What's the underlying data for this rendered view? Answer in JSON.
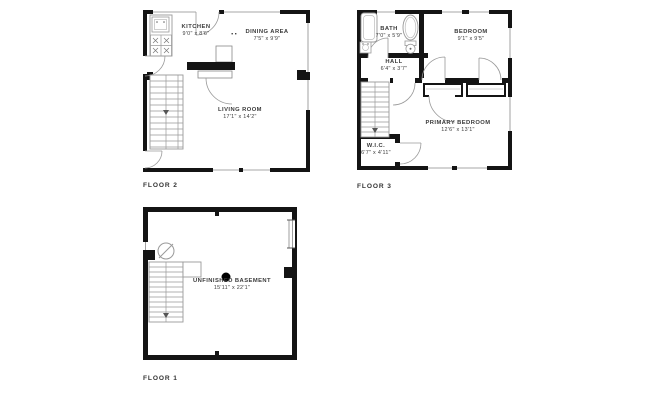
{
  "colors": {
    "wall": "#141414",
    "fixture_line": "#999999",
    "text": "#333333",
    "background": "#ffffff"
  },
  "floor2": {
    "label": "FLOOR 2",
    "kitchen": {
      "name": "KITCHEN",
      "dims": "9'0\" x 8'6\""
    },
    "dining": {
      "name": "DINING AREA",
      "dims": "7'5\" x 9'9\""
    },
    "living": {
      "name": "LIVING ROOM",
      "dims": "17'1\" x 14'2\""
    },
    "fixtures": [
      "stove-icon",
      "sink-icon",
      "stairs-icon",
      "door-arcs",
      "windows"
    ]
  },
  "floor3": {
    "label": "FLOOR 3",
    "bath": {
      "name": "BATH",
      "dims": "7'0\" x 5'9\""
    },
    "bedroom": {
      "name": "BEDROOM",
      "dims": "9'1\" x 9'5\""
    },
    "hall": {
      "name": "HALL",
      "dims": "6'4\" x 3'7\""
    },
    "primary": {
      "name": "PRIMARY BEDROOM",
      "dims": "12'6\" x 13'1\""
    },
    "wic": {
      "name": "W.I.C.",
      "dims": "6'7\" x 4'11\""
    },
    "fixtures": [
      "bathtub-icon",
      "oval-tub-icon",
      "toilet-icon",
      "sink-icon",
      "stairs-icon",
      "closets",
      "door-arcs",
      "windows"
    ]
  },
  "floor1": {
    "label": "FLOOR 1",
    "basement": {
      "name": "UNFINISHED BASEMENT",
      "dims": "15'11\" x 22'1\""
    },
    "fixtures": [
      "light-fixture-icon",
      "support-column-icon",
      "stairs-icon",
      "window"
    ]
  }
}
